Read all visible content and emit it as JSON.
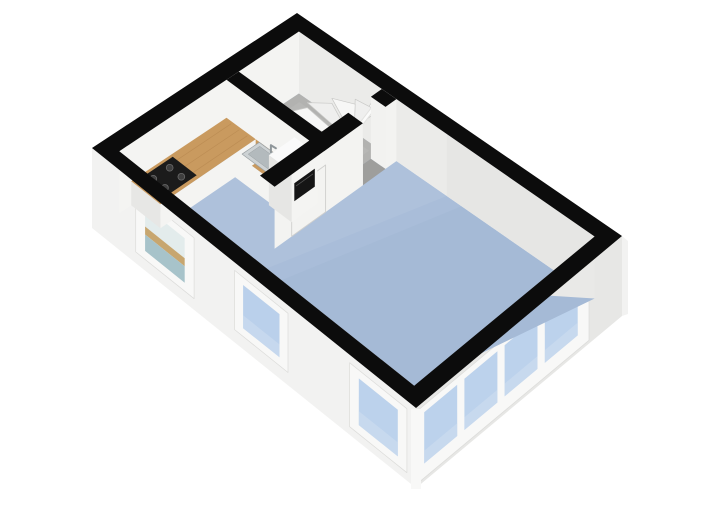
{
  "palette": {
    "background": "#ffffff",
    "wall_cut": "#0c0c0c",
    "ext_face": "#f2f2f1",
    "ext_face_dark": "#e7e7e5",
    "int_face_ne": "#ebebe9",
    "int_face_nw": "#f4f4f2",
    "int_face_shadow": "#e0e0de",
    "floor_blue_light": "#b4c6dd",
    "floor_blue": "#a9bdd9",
    "floor_blue_dark": "#9fb4d2",
    "floor_gray": "#b2b2b0",
    "floor_gray_dark": "#9e9e9c",
    "wedge_white": "#e9e9e7",
    "window_frame": "#f8f8f7",
    "window_frame_edge": "#dcdcda",
    "glass_blue": "#bcd2ec",
    "glass_blue_2": "#bad0eb",
    "glass_int_wall": "#e3ecec",
    "glass_int_wood": "#c7a66f",
    "glass_int_floor": "#a7c3ca",
    "wood": "#c99a5f",
    "wood_line": "#b08049",
    "counter_white": "#f4f4f2",
    "counter_side": "#e7e7e5",
    "cabinet_side": "#e6e6e4",
    "cooktop_black": "#1b1b1b",
    "burner": "#3f3f3f",
    "burner_ring": "#6a6a6a",
    "oven_black": "#151515",
    "sink_rim": "#cdd2d4",
    "sink_basin": "#b3babd",
    "sink_edge": "#9aa0a3",
    "faucet": "#8f969a",
    "door_face": "#f3f3f1",
    "door_edge": "#cfcfcd",
    "handle": "#8b8b8b",
    "tread_a": "#f7f7f6",
    "tread_b": "#efefee",
    "tread_edge": "#c9c9c7",
    "rail_white": "#fbfbfa",
    "rail_gray": "#e2e2e0",
    "jamb_light": "#f2f2f0",
    "jamb_dark": "#dcdcda"
  },
  "projection": {
    "quad": {
      "n": [
        297,
        13
      ],
      "e": [
        622,
        236
      ],
      "s": [
        416,
        408
      ],
      "w": [
        92,
        148
      ]
    },
    "inset_a": 0.045,
    "inset_b": 0.062,
    "floor_drop": 62,
    "ext_wall_drop": 80
  },
  "exterior": {
    "sw_wall": {
      "top": [
        [
          92,
          148
        ],
        [
          416,
          408
        ]
      ],
      "bottom": [
        [
          92,
          228
        ],
        [
          416,
          488
        ]
      ],
      "windows": [
        {
          "t": [
            0.135,
            0.315
          ],
          "v": [
            0.1,
            0.86
          ],
          "glass": "interior"
        },
        {
          "t": [
            0.44,
            0.605
          ],
          "v": [
            0.1,
            0.84
          ],
          "glass": "plain"
        },
        {
          "t": [
            0.795,
            0.972
          ],
          "v": [
            0.1,
            0.9
          ],
          "glass": "plain"
        }
      ]
    },
    "se_wall": {
      "top": [
        [
          416,
          408
        ],
        [
          622,
          236
        ]
      ],
      "bottom": [
        [
          416,
          488
        ],
        [
          622,
          316
        ]
      ],
      "band": {
        "t": [
          0.015,
          0.84
        ],
        "v": [
          0.05,
          0.96
        ]
      },
      "panes": {
        "t": [
          [
            0.04,
            0.2
          ],
          [
            0.235,
            0.395
          ],
          [
            0.43,
            0.59
          ],
          [
            0.625,
            0.785
          ]
        ],
        "v": [
          0.14,
          0.78
        ]
      }
    },
    "corner_post": [
      [
        411,
        409
      ],
      [
        421,
        409
      ],
      [
        421,
        489
      ],
      [
        411,
        489
      ]
    ],
    "east_sliver": [
      [
        622,
        236
      ],
      [
        628,
        241
      ],
      [
        628,
        314
      ],
      [
        622,
        316
      ]
    ]
  },
  "interior": {
    "stair_room": {
      "a": [
        0.045,
        0.3
      ],
      "b": [
        0.062,
        0.355
      ]
    },
    "east_wedge": [
      [
        0.955,
        0.062,
        0
      ],
      [
        0.955,
        0.062,
        62
      ],
      [
        0.955,
        0.4,
        0
      ]
    ],
    "walls": {
      "p1": {
        "a": [
          0.045,
          0.345
        ],
        "b": [
          0.355,
          0.415
        ]
      },
      "p2": {
        "a": [
          0.3,
          0.345
        ],
        "segs": [
          [
            0.062,
            0.115
          ],
          [
            0.225,
            0.655
          ]
        ],
        "opening": [
          0.115,
          0.225
        ]
      }
    },
    "door": {
      "face_a": 0.345,
      "b": [
        0.41,
        0.575
      ],
      "dz_top": 14,
      "handle": {
        "b": 0.555,
        "dz": 34
      }
    }
  },
  "stairs": {
    "pivot": [
      0.295,
      0.19
    ],
    "outer": [
      [
        0.085,
        0.355
      ],
      [
        0.102,
        0.298
      ],
      [
        0.113,
        0.232
      ],
      [
        0.134,
        0.162
      ],
      [
        0.173,
        0.104
      ],
      [
        0.222,
        0.068
      ],
      [
        0.266,
        0.058
      ],
      [
        0.294,
        0.056
      ]
    ],
    "dz": [
      52,
      47,
      42,
      37,
      32,
      27,
      22
    ],
    "rail": {
      "from": [
        0.291,
        0.062,
        14
      ],
      "to": [
        0.291,
        0.195,
        30
      ]
    }
  },
  "kitchen": {
    "counter_a": {
      "a": [
        0.045,
        0.135
      ],
      "b": [
        0.415,
        0.88
      ],
      "top_dz": 38
    },
    "counter_b": {
      "a": [
        0.135,
        0.245
      ],
      "b": [
        0.415,
        0.515
      ],
      "top_dz": 38
    },
    "planks_a": [
      0.065,
      0.09,
      0.115
    ],
    "planks_b": [
      0.44,
      0.47,
      0.5
    ],
    "cooktop": {
      "a": [
        0.053,
        0.127
      ],
      "b": [
        0.69,
        0.855
      ],
      "dz": 37.5,
      "burners": [
        [
          0.072,
          0.735
        ],
        [
          0.108,
          0.735
        ],
        [
          0.072,
          0.815
        ],
        [
          0.108,
          0.815
        ]
      ],
      "burner_r": 3.4
    },
    "sink": {
      "rim": {
        "a": [
          0.148,
          0.228
        ],
        "b": [
          0.418,
          0.502
        ],
        "dz": 37.6
      },
      "basin": {
        "a": [
          0.158,
          0.218
        ],
        "b": [
          0.432,
          0.488
        ],
        "dz": 37.2
      },
      "faucet": {
        "a": 0.188,
        "b": 0.425,
        "dz": 37
      }
    },
    "cabinet": {
      "a": [
        0.245,
        0.315
      ],
      "b": [
        0.4,
        0.525
      ],
      "top_dz": 12,
      "oven": {
        "b": [
          0.415,
          0.515
        ],
        "dz": [
          24,
          42
        ]
      }
    }
  }
}
